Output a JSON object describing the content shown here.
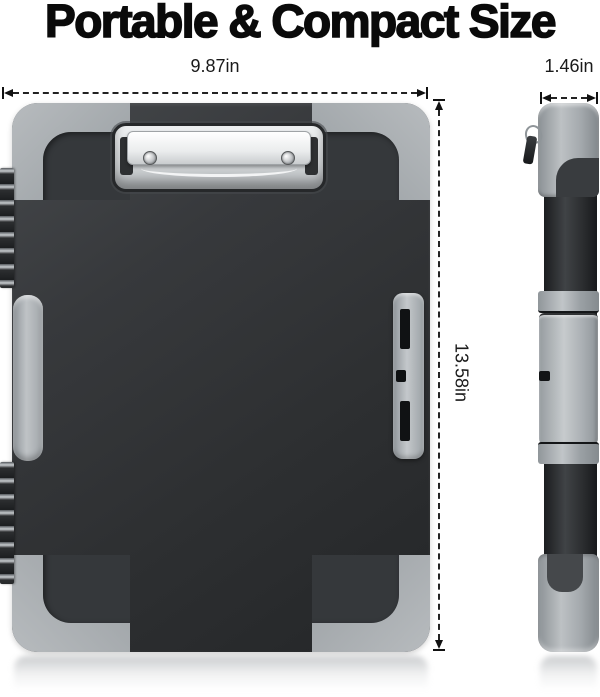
{
  "title": "Portable & Compact Size",
  "dimension_labels": {
    "front_width": "9.87in",
    "front_height": "13.58in",
    "side_depth": "1.46in"
  },
  "colors": {
    "background": "#ffffff",
    "body_charcoal": "#2e3032",
    "trim_gray": "#a6abaf",
    "clip_chrome": "#eceeef",
    "annotation": "#111111"
  }
}
